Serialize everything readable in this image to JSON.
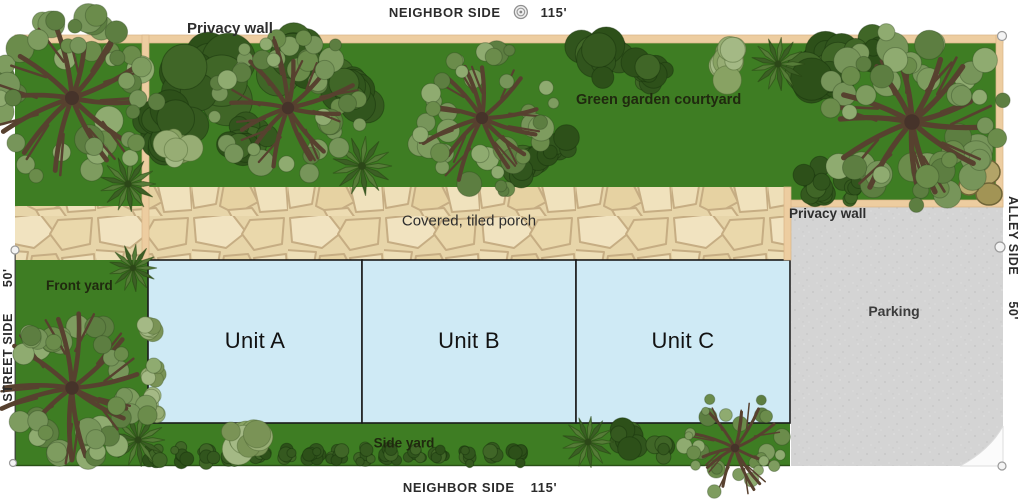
{
  "plan": {
    "boundaries": {
      "top": {
        "label": "NEIGHBOR SIDE",
        "dimension": "115'"
      },
      "bottom": {
        "label": "NEIGHBOR SIDE",
        "dimension": "115'"
      },
      "left": {
        "label": "STREET SIDE",
        "dimension": "50'"
      },
      "right": {
        "label": "ALLEY SIDE",
        "dimension": "50'"
      }
    },
    "walls": {
      "top_label": "Privacy wall",
      "right_label": "Privacy wall"
    },
    "areas": {
      "courtyard_label": "Green garden courtyard",
      "porch_label": "Covered, tiled porch",
      "front_yard_label": "Front yard",
      "side_yard_label": "Side yard",
      "parking_label": "Parking"
    },
    "units": [
      {
        "label": "Unit A"
      },
      {
        "label": "Unit B"
      },
      {
        "label": "Unit C"
      }
    ],
    "colors": {
      "grass": "#3e7d23",
      "hedge_dark": "#33591f",
      "porch_tile": "#e9d7ab",
      "tile_joint": "#c6ad83",
      "unit_fill": "#cfeaf5",
      "unit_border": "#1a1a1a",
      "parking": "#d4d4d4",
      "privacy_wall": "#edcda0",
      "label_text": "#1f1f1f"
    }
  }
}
